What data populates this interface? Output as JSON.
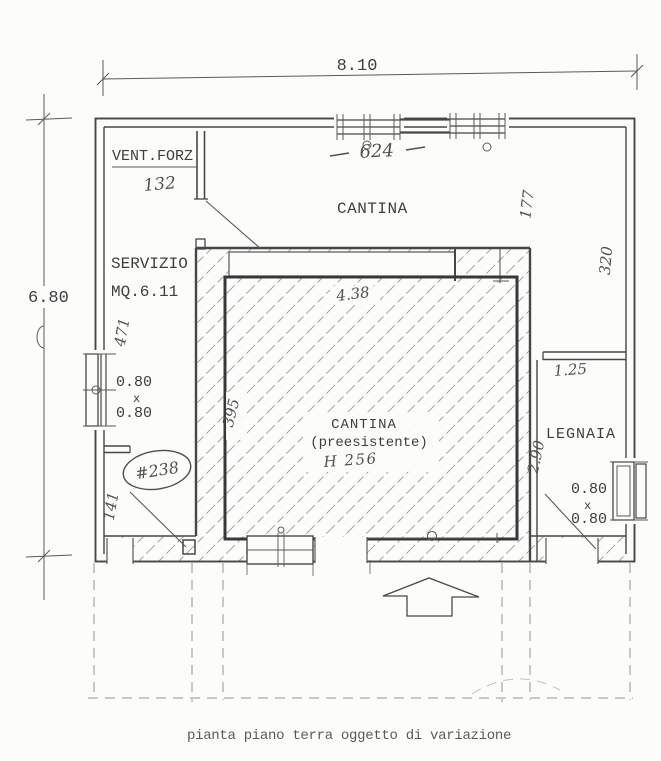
{
  "caption": "pianta piano terra oggetto di variazione",
  "dims": {
    "total_width": "8.10",
    "total_height": "6.80"
  },
  "rooms": {
    "vent_forz": {
      "label": "VENT.FORZ",
      "height_dim": "132"
    },
    "cantina": {
      "label": "CANTINA",
      "windows_span_dim": "624",
      "depth_dim": "177",
      "right_wall_dim": "320"
    },
    "servizio": {
      "label": "SERVIZIO",
      "area": "MQ.6.11",
      "left_dim": "471",
      "corridor_dim": "141",
      "window": {
        "w": "0.80",
        "sep": "x",
        "h": "0.80"
      }
    },
    "cantina_preesistente": {
      "label": "CANTINA",
      "sublabel": "(preesistente)",
      "height_note": "H 256",
      "top_dim": "4.38",
      "left_dim": "395"
    },
    "legnaia": {
      "label": "LEGNAIA",
      "opening_dim": "1.25",
      "depth_dim": "2.90",
      "window": {
        "w": "0.80",
        "sep": "x",
        "h": "0.80"
      }
    },
    "note_circled": "#238"
  },
  "colors": {
    "paper": "#fcfcfb",
    "ink": "#474747",
    "hatch": "#a2a2a2"
  }
}
